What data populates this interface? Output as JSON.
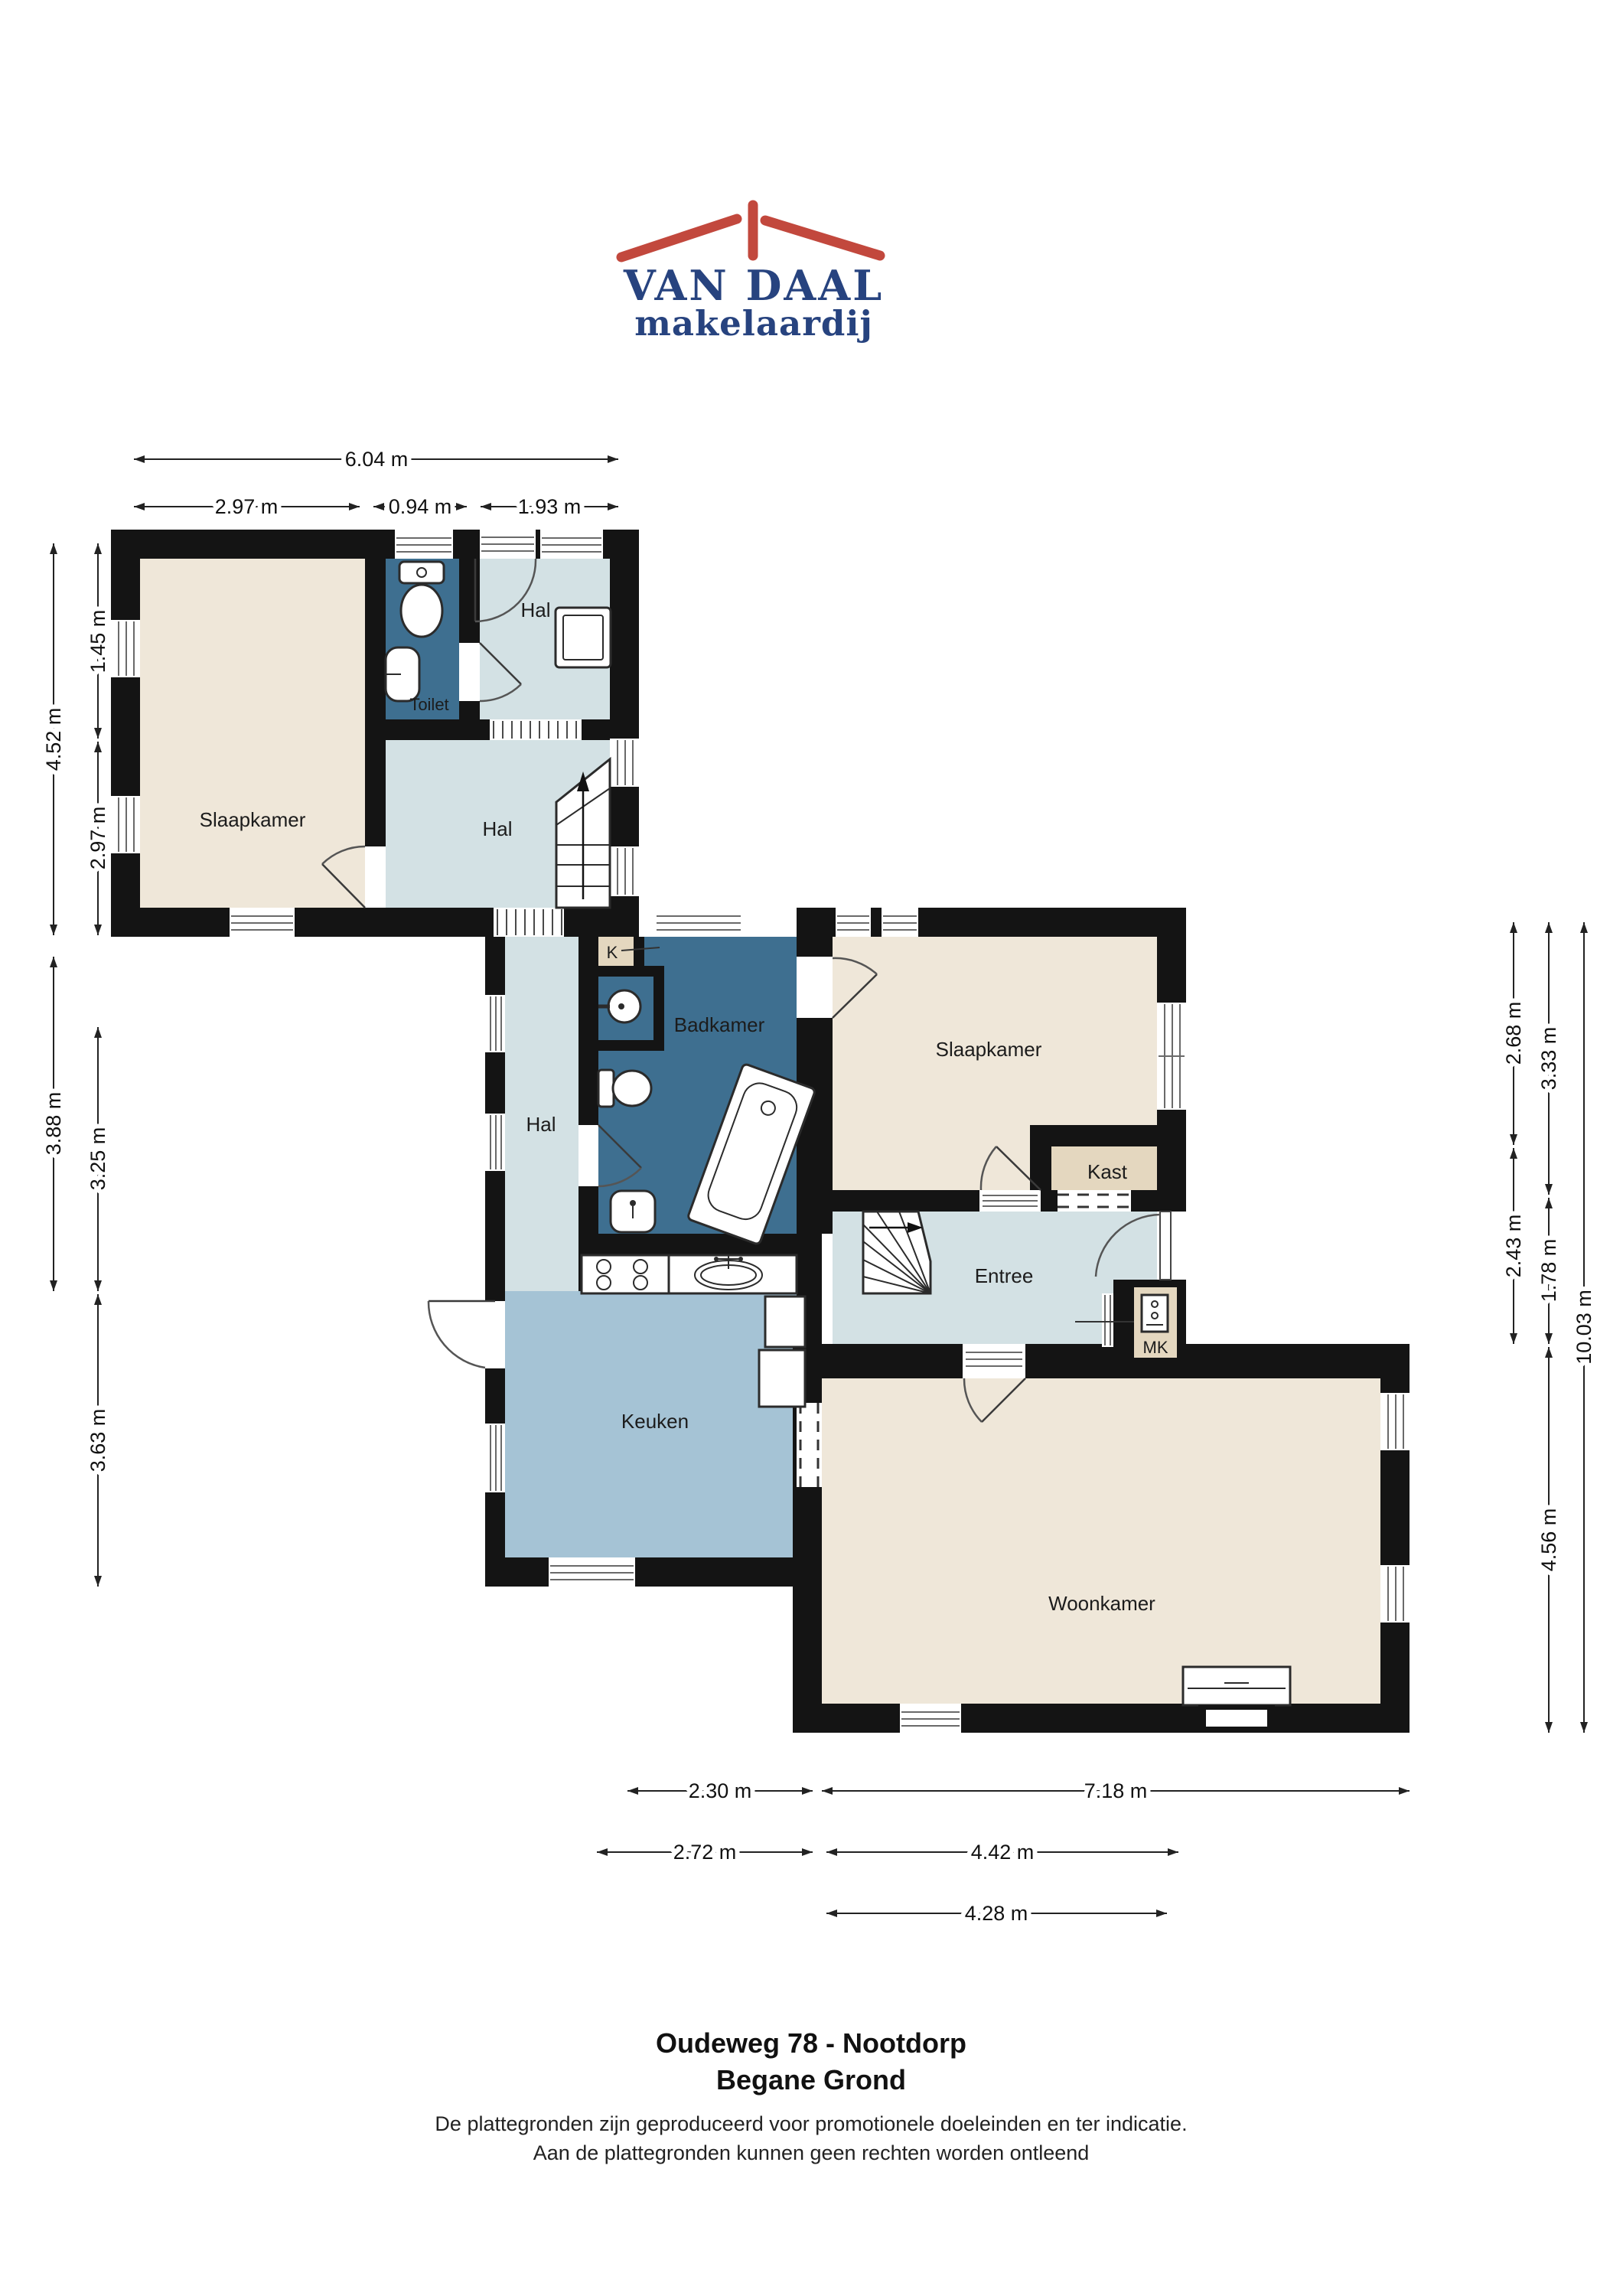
{
  "logo": {
    "line1": "VAN DAAL",
    "line2": "makelaardij",
    "roof_color": "#c2483d",
    "text_color": "#27437f"
  },
  "rooms": {
    "slaapkamer_left": "Slaapkamer",
    "toilet": "Toilet",
    "hal_top": "Hal",
    "hal_main": "Hal",
    "hal_corridor": "Hal",
    "k_closet": "K",
    "badkamer": "Badkamer",
    "slaapkamer_right": "Slaapkamer",
    "kast": "Kast",
    "entree": "Entree",
    "mk": "MK",
    "keuken": "Keuken",
    "woonkamer": "Woonkamer"
  },
  "dimensions": {
    "top": [
      "6.04 m",
      "2.97 m",
      "0.94 m",
      "1.93 m"
    ],
    "left": [
      "4.52 m",
      "3.88 m",
      "1.45 m",
      "2.97 m",
      "3.25 m",
      "3.63 m"
    ],
    "right": [
      "2.68 m",
      "2.43 m",
      "3.33 m",
      "1.78 m",
      "4.56 m",
      "10.03 m"
    ],
    "bottom": [
      "2.30 m",
      "7.18 m",
      "2.72 m",
      "4.42 m",
      "4.28 m"
    ]
  },
  "footer": {
    "address": "Oudeweg 78 - Nootdorp",
    "floor": "Begane Grond",
    "disclaimer1": "De plattegronden zijn geproduceerd voor promotionele doeleinden en ter indicatie.",
    "disclaimer2": "Aan de plattegronden kunnen geen rechten worden ontleend"
  },
  "colors": {
    "walls": "#141414",
    "bedroom_living": "#efe7d9",
    "hall": "#d3e1e4",
    "kitchen": "#a5c3d5",
    "bathroom": "#3e6f90",
    "closet": "#e4d7bf"
  }
}
